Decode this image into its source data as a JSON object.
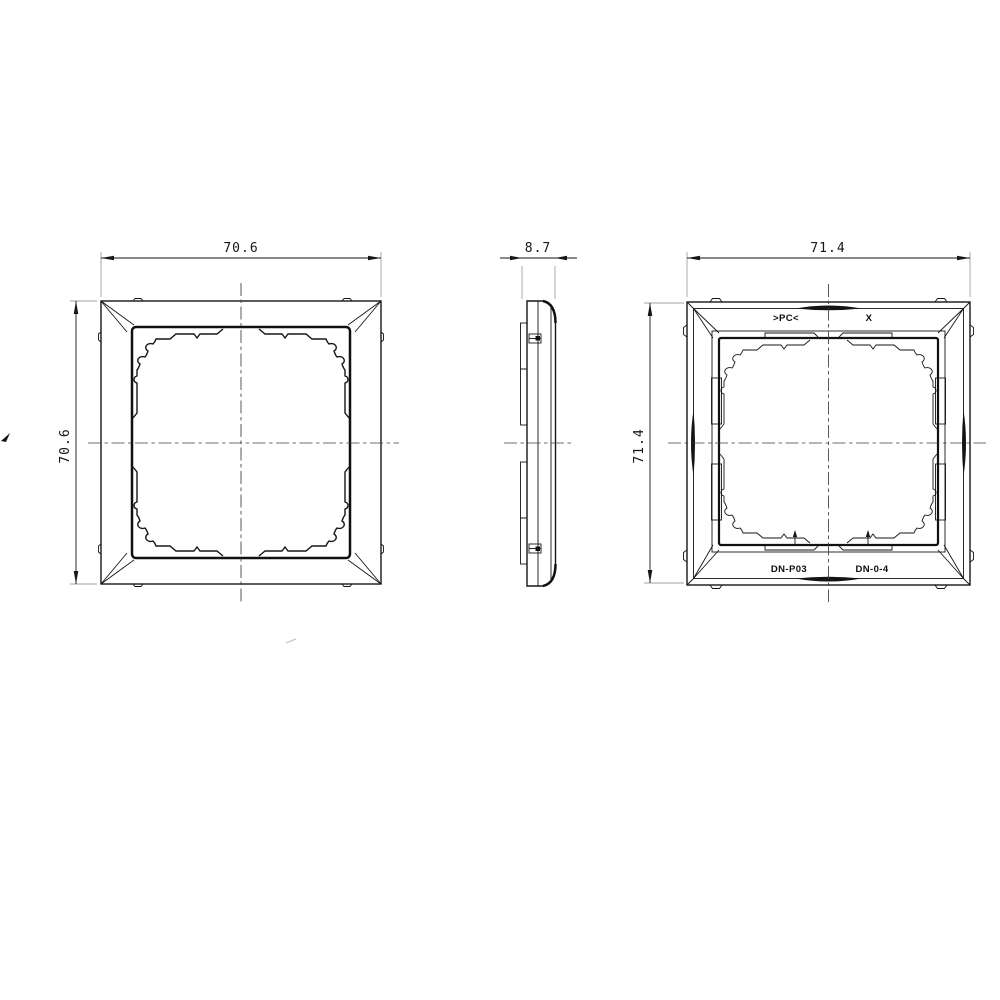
{
  "drawing": {
    "views": {
      "front": {
        "width_dim": "70.6",
        "height_dim": "70.6"
      },
      "side": {
        "thickness_dim": "8.7"
      },
      "back": {
        "width_dim": "71.4",
        "height_dim": "71.4",
        "markings": {
          "material": ">PC<",
          "cavity": "X",
          "part_left": "DN-P03",
          "part_right": "DN-0-4"
        }
      }
    },
    "colors": {
      "line": "#161616",
      "extension_line": "#a0a0a0",
      "centerline": "#3d3d3d",
      "background": "#ffffff"
    }
  }
}
